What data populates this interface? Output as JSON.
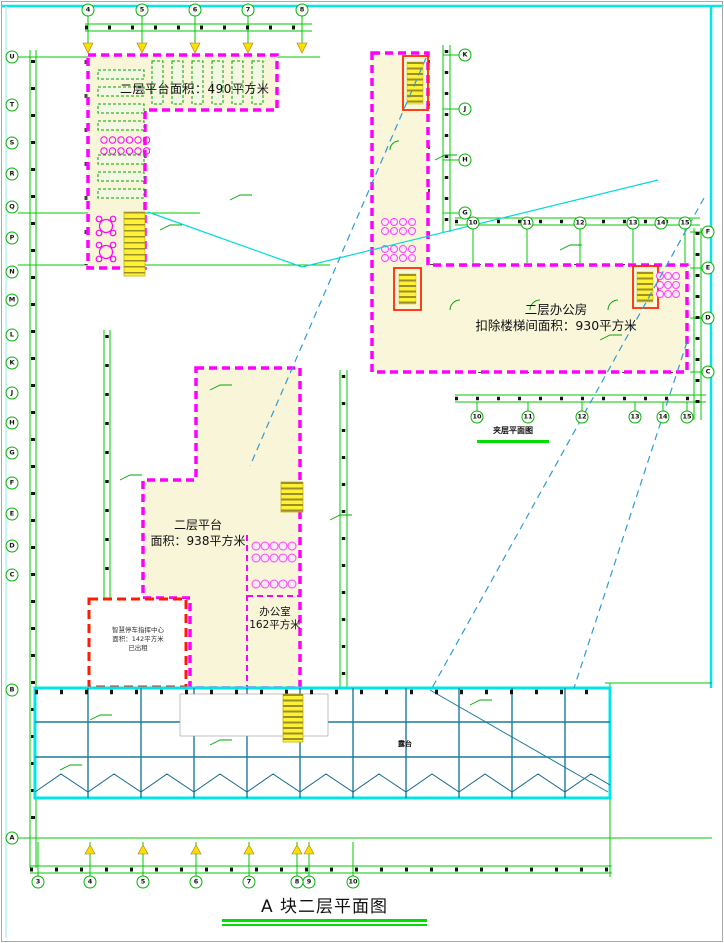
{
  "drawing": {
    "title": "A 块二层平面图",
    "sub_caption": "夹层平面图",
    "area_labels": {
      "platform_top": "二层平台面积：490平方米",
      "office_block_line1": "二层办公房",
      "office_block_line2": "扣除楼梯间面积：930平方米",
      "platform_mid_line1": "二层平台",
      "platform_mid_line2": "面积：938平方米",
      "office_room_line1": "办公室",
      "office_room_line2": "162平方米",
      "smart_parking_line1": "智慧停车指挥中心",
      "smart_parking_line2": "面积：142平方米",
      "smart_parking_line3": "已出租",
      "terrace": "露台"
    },
    "colors": {
      "boundary_magenta": "#FF00FF",
      "axis_green": "#00C800",
      "highlight_red": "#FF2A00",
      "walkway_cyan": "#00E5E5",
      "canopy_teal": "#1B7A9E",
      "fill_pale_yellow": "#F9F5D8",
      "stair_yellow": "#FFF235"
    },
    "grid_bubbles": {
      "top": [
        {
          "label": "4",
          "x": 88,
          "y": 10
        },
        {
          "label": "5",
          "x": 142,
          "y": 10
        },
        {
          "label": "6",
          "x": 195,
          "y": 10
        },
        {
          "label": "7",
          "x": 248,
          "y": 10
        },
        {
          "label": "8",
          "x": 302,
          "y": 10
        }
      ],
      "bottom": [
        {
          "label": "3",
          "x": 38,
          "y": 882
        },
        {
          "label": "4",
          "x": 90,
          "y": 882
        },
        {
          "label": "5",
          "x": 143,
          "y": 882
        },
        {
          "label": "6",
          "x": 196,
          "y": 882
        },
        {
          "label": "7",
          "x": 249,
          "y": 882
        },
        {
          "label": "8",
          "x": 297,
          "y": 882
        },
        {
          "label": "9",
          "x": 309,
          "y": 882
        },
        {
          "label": "10",
          "x": 353,
          "y": 882
        }
      ],
      "left": [
        {
          "label": "U",
          "x": 12,
          "y": 57
        },
        {
          "label": "T",
          "x": 12,
          "y": 105
        },
        {
          "label": "S",
          "x": 12,
          "y": 143
        },
        {
          "label": "R",
          "x": 12,
          "y": 174
        },
        {
          "label": "Q",
          "x": 12,
          "y": 207
        },
        {
          "label": "P",
          "x": 12,
          "y": 238
        },
        {
          "label": "N",
          "x": 12,
          "y": 272
        },
        {
          "label": "M",
          "x": 12,
          "y": 300
        },
        {
          "label": "L",
          "x": 12,
          "y": 335
        },
        {
          "label": "K",
          "x": 12,
          "y": 363
        },
        {
          "label": "J",
          "x": 12,
          "y": 393
        },
        {
          "label": "H",
          "x": 12,
          "y": 423
        },
        {
          "label": "G",
          "x": 12,
          "y": 453
        },
        {
          "label": "F",
          "x": 12,
          "y": 483
        },
        {
          "label": "E",
          "x": 12,
          "y": 514
        },
        {
          "label": "D",
          "x": 12,
          "y": 546
        },
        {
          "label": "C",
          "x": 12,
          "y": 575
        },
        {
          "label": "B",
          "x": 12,
          "y": 690
        },
        {
          "label": "A",
          "x": 12,
          "y": 838
        }
      ],
      "right_edge": [
        {
          "label": "F",
          "x": 708,
          "y": 232
        },
        {
          "label": "E",
          "x": 708,
          "y": 268
        },
        {
          "label": "D",
          "x": 708,
          "y": 318
        },
        {
          "label": "C",
          "x": 708,
          "y": 372
        }
      ],
      "wing_column": [
        {
          "label": "K",
          "x": 465,
          "y": 55
        },
        {
          "label": "J",
          "x": 465,
          "y": 109
        },
        {
          "label": "H",
          "x": 465,
          "y": 160
        },
        {
          "label": "G",
          "x": 465,
          "y": 213
        }
      ],
      "above_wing": [
        {
          "label": "10",
          "x": 473,
          "y": 223
        },
        {
          "label": "11",
          "x": 527,
          "y": 223
        },
        {
          "label": "12",
          "x": 580,
          "y": 223
        },
        {
          "label": "13",
          "x": 633,
          "y": 223
        },
        {
          "label": "14",
          "x": 661,
          "y": 223
        },
        {
          "label": "15",
          "x": 685,
          "y": 223
        }
      ],
      "under_wing": [
        {
          "label": "10",
          "x": 477,
          "y": 417
        },
        {
          "label": "11",
          "x": 528,
          "y": 417
        },
        {
          "label": "12",
          "x": 582,
          "y": 417
        },
        {
          "label": "13",
          "x": 635,
          "y": 417
        },
        {
          "label": "14",
          "x": 663,
          "y": 417
        },
        {
          "label": "15",
          "x": 687,
          "y": 417
        }
      ]
    }
  }
}
